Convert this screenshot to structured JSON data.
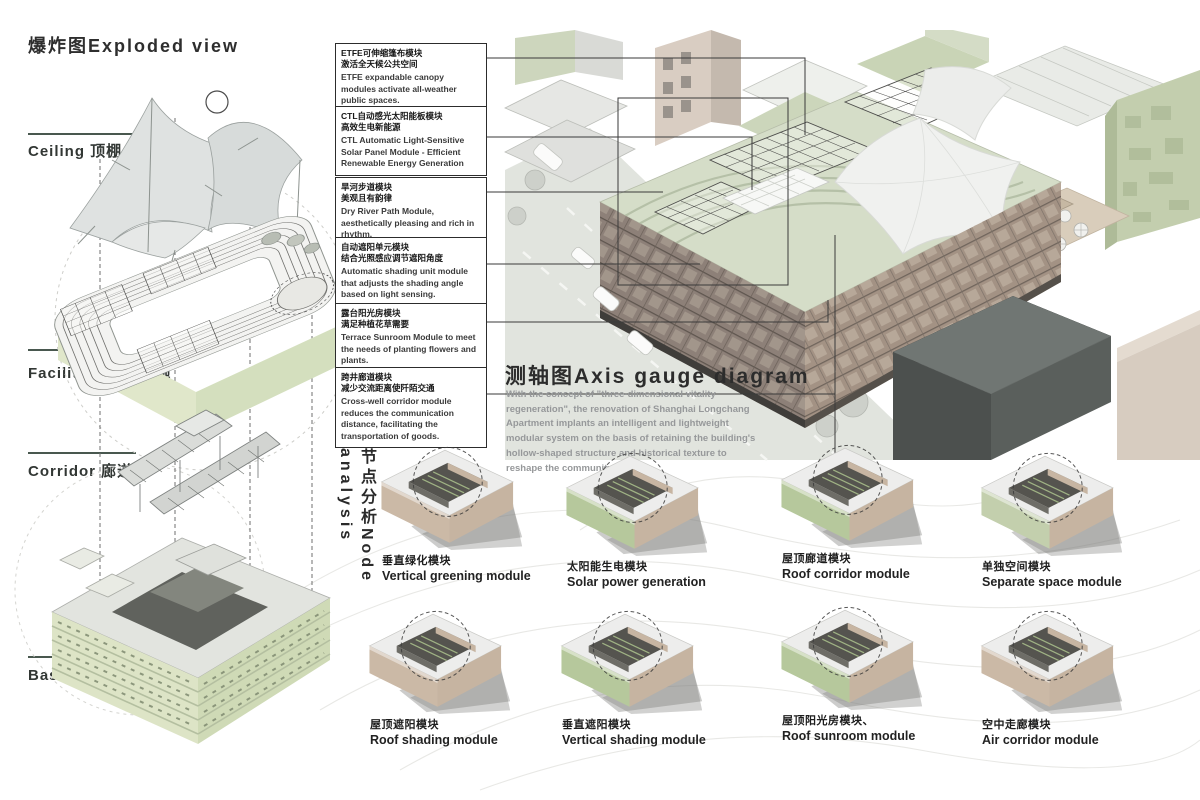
{
  "exploded": {
    "title": "爆炸图Exploded view",
    "layers": [
      {
        "label": "Ceiling 顶棚"
      },
      {
        "label": "Facilities 改造设施"
      },
      {
        "label": "Corridor 廊道"
      },
      {
        "label": "Basic 基础层"
      }
    ]
  },
  "annotations": [
    {
      "zh1": "ETFE可伸缩篷布模块",
      "zh2": "激活全天候公共空间",
      "en": "ETFE expandable canopy modules activate all-weather public spaces."
    },
    {
      "zh1": "CTL自动感光太阳能板模块",
      "zh2": "高效生电新能源",
      "en": "CTL Automatic Light-Sensitive Solar Panel Module - Efficient Renewable Energy Generation"
    },
    {
      "zh1": "旱河步道模块",
      "zh2": "美观且有韵律",
      "en": "Dry River Path Module, aesthetically pleasing and rich in rhythm."
    },
    {
      "zh1": "自动遮阳单元模块",
      "zh2": "结合光照感应调节遮阳角度",
      "en": "Automatic shading unit module that adjusts the shading angle based on light sensing."
    },
    {
      "zh1": "露台阳光房模块",
      "zh2": "满足种植花草需要",
      "en": "Terrace Sunroom Module to meet the needs of planting flowers and plants."
    },
    {
      "zh1": "跨井廊道模块",
      "zh2": "减少交流距离使阡陌交通",
      "en": "Cross-well corridor module reduces the communication distance, facilitating the transportation of goods."
    }
  ],
  "axis": {
    "title": "测轴图Axis gauge diagram",
    "description": "With the concept of \"three-dimensional vitality regeneration\", the renovation of Shanghai Longchang Apartment implants an intelligent and lightweight modular system on the basis of retaining the building's hollow-shaped structure and historical texture to reshape the community ecology."
  },
  "node": {
    "title": "节点分析Node analysis"
  },
  "modules": [
    {
      "zh": "垂直绿化模块",
      "en": "Vertical greening module",
      "face": "#cbb9a6"
    },
    {
      "zh": "太阳能生电模块",
      "en": "Solar power generation",
      "face": "#b6c89c"
    },
    {
      "zh": "屋顶廊道模块",
      "en": "Roof corridor module",
      "face": "#b6c89c"
    },
    {
      "zh": "单独空间模块",
      "en": "Separate space module",
      "face": "#c3cfad"
    },
    {
      "zh": "屋顶遮阳模块",
      "en": "Roof shading module",
      "face": "#cbb9a6"
    },
    {
      "zh": "垂直遮阳模块",
      "en": "Vertical shading module",
      "face": "#b6c89c"
    },
    {
      "zh": "屋顶阳光房模块、",
      "en": "Roof sunroom module",
      "face": "#b6c89c"
    },
    {
      "zh": "空中走廊模块",
      "en": "Air corridor module",
      "face": "#cbb9a6"
    }
  ],
  "colors": {
    "accent_line": "#49584f",
    "green_facade": "#dde4c6",
    "brick": "#8d8078",
    "pale_green_building": "#c3ceae",
    "leader": "#3a3a3a"
  }
}
